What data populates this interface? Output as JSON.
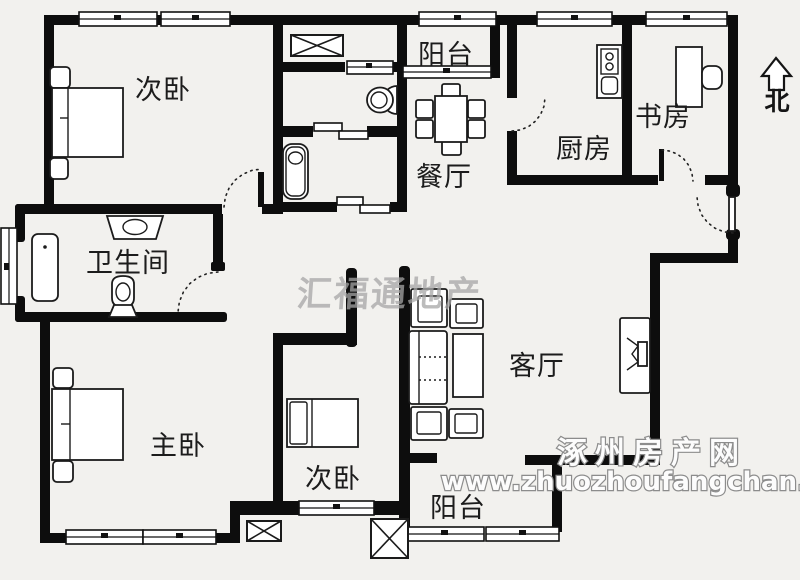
{
  "page": {
    "background": "#f2f1ee"
  },
  "colors": {
    "wall": "#0d0d0d",
    "furniture_stroke": "#1b1b1b",
    "label": "#1c1c1c",
    "watermark_gray": "#a6a6a6",
    "watermark_fill": "#fcfcfc",
    "watermark_outline": "#8c8c8c"
  },
  "rooms": [
    {
      "id": "bedroom-top-left",
      "label": "次卧"
    },
    {
      "id": "balcony-top",
      "label": "阳台"
    },
    {
      "id": "dining-room",
      "label": "餐厅"
    },
    {
      "id": "kitchen",
      "label": "厨房"
    },
    {
      "id": "study",
      "label": "书房"
    },
    {
      "id": "bathroom",
      "label": "卫生间"
    },
    {
      "id": "living-room",
      "label": "客厅"
    },
    {
      "id": "master-bedroom",
      "label": "主卧"
    },
    {
      "id": "bedroom-bottom",
      "label": "次卧"
    },
    {
      "id": "balcony-bottom",
      "label": "阳台"
    }
  ],
  "compass": {
    "north_label": "北"
  },
  "watermarks": {
    "center_brand": "汇福通地产",
    "site_name": "涿州房产网",
    "site_url": "www.zhuozhoufangchan.com"
  }
}
